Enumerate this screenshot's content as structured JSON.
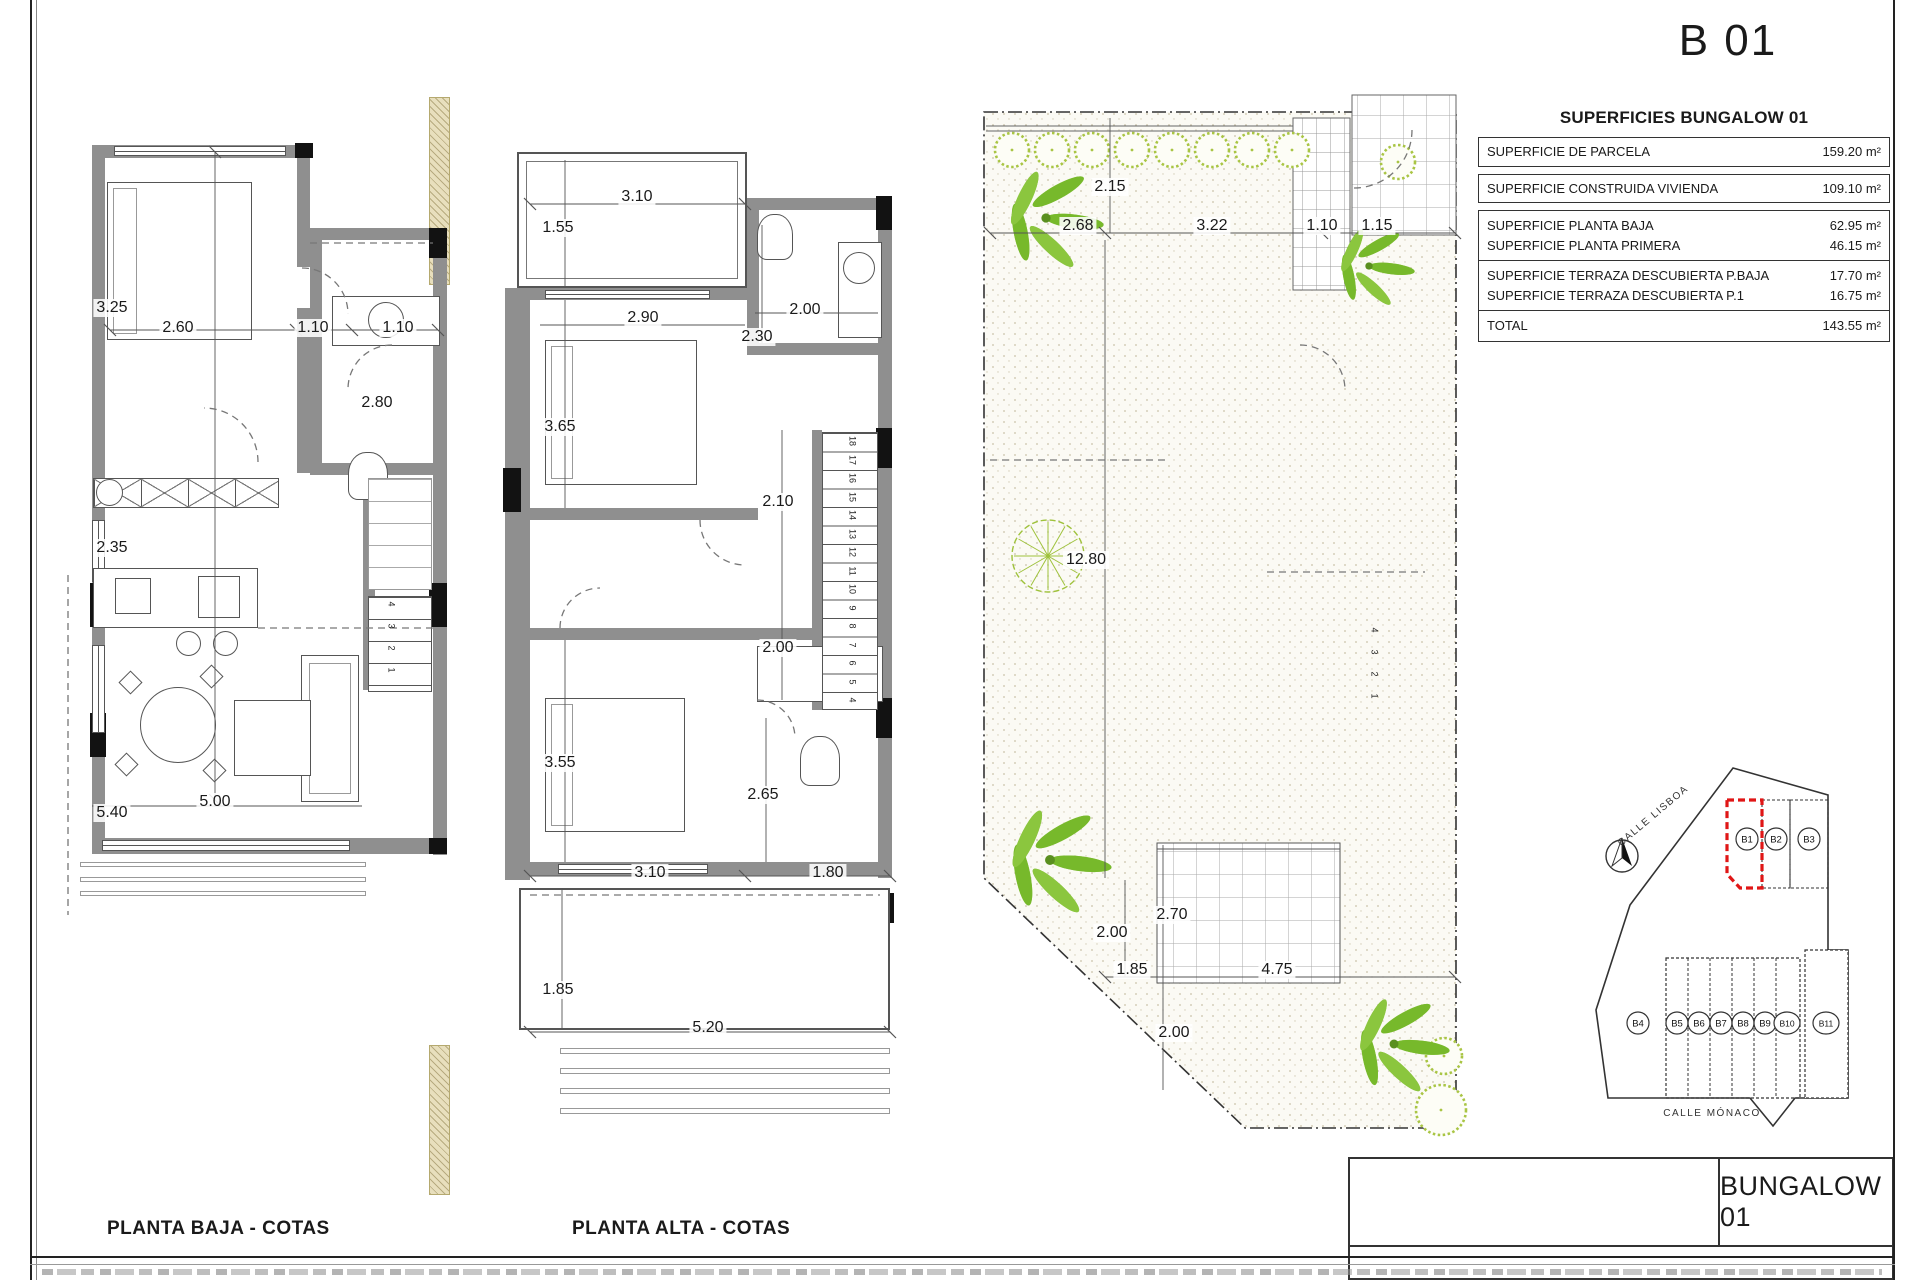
{
  "page": {
    "sheet_code": "B 01",
    "title_block_label": "BUNGALOW 01",
    "captions": {
      "left_plan": "PLANTA BAJA - COTAS",
      "middle_plan": "PLANTA ALTA - COTAS"
    }
  },
  "surfaces_table": {
    "title": "SUPERFICIES BUNGALOW 01",
    "groups": [
      {
        "boxed": true,
        "rows": [
          {
            "label": "SUPERFICIE DE PARCELA",
            "value": "159.20 m²"
          }
        ]
      },
      {
        "boxed": true,
        "rows": [
          {
            "label": "SUPERFICIE CONSTRUIDA VIVIENDA",
            "value": "109.10 m²"
          }
        ]
      },
      {
        "boxed": false,
        "rows": [
          {
            "label": "SUPERFICIE PLANTA BAJA",
            "value": "62.95 m²"
          },
          {
            "label": "SUPERFICIE PLANTA PRIMERA",
            "value": "46.15 m²"
          }
        ]
      },
      {
        "boxed": false,
        "rows": [
          {
            "label": "SUPERFICIE TERRAZA DESCUBIERTA P.BAJA",
            "value": "17.70 m²"
          },
          {
            "label": "SUPERFICIE TERRAZA DESCUBIERTA P.1",
            "value": "16.75 m²"
          }
        ]
      },
      {
        "boxed": false,
        "rows": [
          {
            "label": "TOTAL",
            "value": "143.55 m²"
          }
        ]
      }
    ]
  },
  "plans": {
    "planta_baja": {
      "dims": [
        {
          "t": "3.25",
          "x": 112,
          "y": 308
        },
        {
          "t": "2.60",
          "x": 178,
          "y": 328
        },
        {
          "t": "1.10",
          "x": 313,
          "y": 328
        },
        {
          "t": "1.10",
          "x": 398,
          "y": 328
        },
        {
          "t": "2.80",
          "x": 377,
          "y": 403
        },
        {
          "t": "2.35",
          "x": 112,
          "y": 548
        },
        {
          "t": "5.40",
          "x": 112,
          "y": 813
        },
        {
          "t": "5.00",
          "x": 215,
          "y": 802
        }
      ],
      "stair_numbers": [
        "4",
        "3",
        "2",
        "1"
      ]
    },
    "planta_alta": {
      "dims": [
        {
          "t": "3.10",
          "x": 637,
          "y": 197
        },
        {
          "t": "1.55",
          "x": 558,
          "y": 228
        },
        {
          "t": "2.90",
          "x": 643,
          "y": 318
        },
        {
          "t": "2.00",
          "x": 805,
          "y": 310
        },
        {
          "t": "2.30",
          "x": 757,
          "y": 337
        },
        {
          "t": "3.65",
          "x": 560,
          "y": 427
        },
        {
          "t": "2.10",
          "x": 778,
          "y": 502
        },
        {
          "t": "2.00",
          "x": 778,
          "y": 648
        },
        {
          "t": "3.55",
          "x": 560,
          "y": 763
        },
        {
          "t": "2.65",
          "x": 763,
          "y": 795
        },
        {
          "t": "3.10",
          "x": 650,
          "y": 873
        },
        {
          "t": "1.80",
          "x": 828,
          "y": 873
        },
        {
          "t": "1.85",
          "x": 558,
          "y": 990
        },
        {
          "t": "5.20",
          "x": 708,
          "y": 1028
        }
      ],
      "stair_numbers": [
        "18",
        "17",
        "16",
        "15",
        "14",
        "13",
        "12",
        "11",
        "10",
        "9",
        "8",
        "7",
        "6",
        "5",
        "4"
      ]
    },
    "site_plan": {
      "dims": [
        {
          "t": "2.15",
          "x": 1110,
          "y": 187
        },
        {
          "t": "2.68",
          "x": 1078,
          "y": 226
        },
        {
          "t": "3.22",
          "x": 1212,
          "y": 226
        },
        {
          "t": "1.10",
          "x": 1322,
          "y": 226
        },
        {
          "t": "1.15",
          "x": 1377,
          "y": 226
        },
        {
          "t": "12.80",
          "x": 1086,
          "y": 560
        },
        {
          "t": "2.70",
          "x": 1172,
          "y": 915
        },
        {
          "t": "2.00",
          "x": 1112,
          "y": 933
        },
        {
          "t": "1.85",
          "x": 1132,
          "y": 970
        },
        {
          "t": "4.75",
          "x": 1277,
          "y": 970
        },
        {
          "t": "2.00",
          "x": 1174,
          "y": 1033
        }
      ],
      "stair_numbers": [
        "4",
        "3",
        "2",
        "1"
      ]
    }
  },
  "site_map": {
    "streets": [
      "CALLE LISBOA",
      "CALLE MÓNACO"
    ],
    "plots_top": [
      "B1",
      "B2",
      "B3"
    ],
    "plots_bottom": [
      "B4",
      "B5",
      "B6",
      "B7",
      "B8",
      "B9",
      "B10",
      "B11"
    ],
    "highlighted_plot": "B1",
    "north_icon": "compass-north-icon"
  },
  "colors": {
    "highlight_red": "#e01616",
    "wall_gray": "#8f8f8f",
    "palm_green": "#76b82a",
    "hedge_green": "#a9c544",
    "party_wall_tan": "#e8dfbd"
  }
}
